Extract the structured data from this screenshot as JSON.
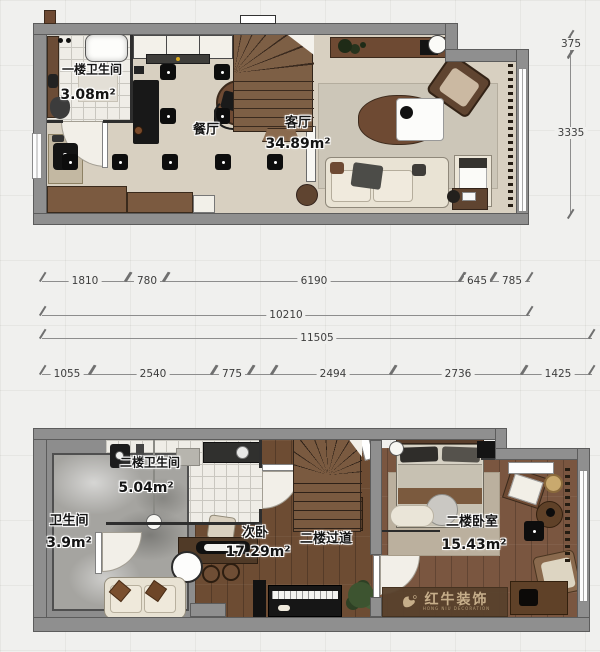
{
  "floor1": {
    "bathroom_name": "一楼卫生间",
    "bathroom_area": "3.08m²",
    "dining_name": "餐厅",
    "living_name": "客厅",
    "living_area": "34.89m²"
  },
  "floor2": {
    "bath_small_name": "卫生间",
    "bath_small_area": "3.9m²",
    "bath_name": "二楼卫生间",
    "bath_area": "5.04m²",
    "bedroom2_name": "次卧",
    "bedroom2_area": "17.29m²",
    "corridor_name": "二楼过道",
    "master_name": "二楼卧室",
    "master_area": "15.43m²"
  },
  "dimensions": {
    "row1": [
      "1810",
      "780",
      "6190",
      "645",
      "785"
    ],
    "row2": [
      "10210"
    ],
    "row3": [
      "11505"
    ],
    "row4": [
      "1055",
      "2540",
      "775",
      "2494",
      "2736",
      "1425"
    ],
    "vertical": [
      "375",
      "3335"
    ]
  },
  "watermark": {
    "brand": "红牛装饰",
    "sub": "HONG NIU DECORATION"
  },
  "colors": {
    "wall": "#8f8f8f",
    "floor_beige": "#d8d0c1",
    "wood_dark": "#6d4c33",
    "wood_master": "#7a5640",
    "brand_text": "#c6ae8a",
    "brand_bg": "#58422d"
  }
}
